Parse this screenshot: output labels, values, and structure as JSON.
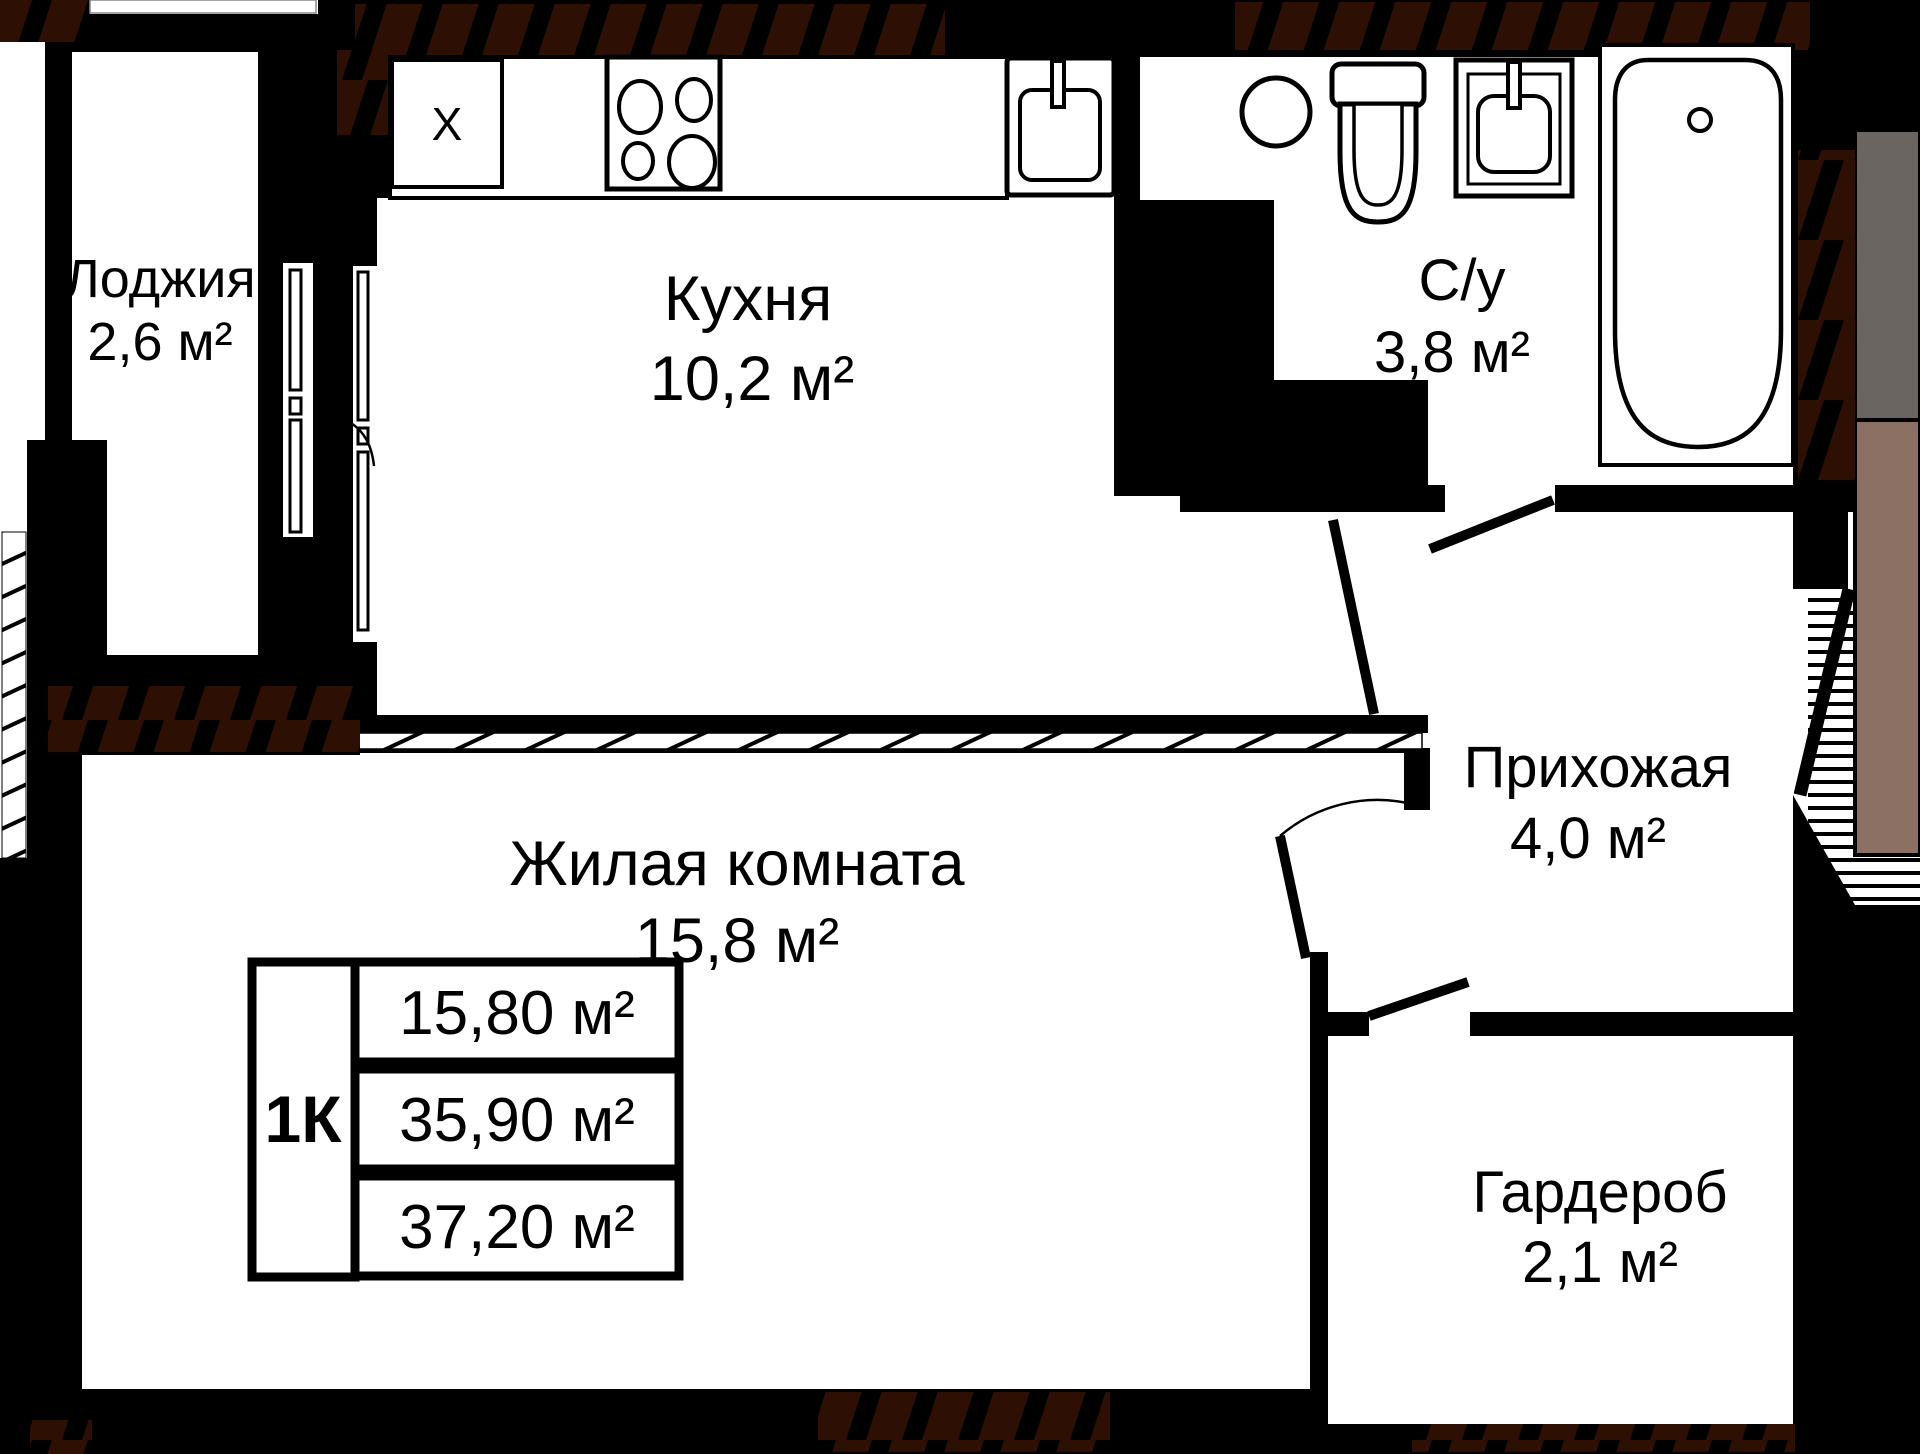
{
  "rooms": {
    "loggia": {
      "name": "Лоджия",
      "area": "2,6 м²"
    },
    "kitchen": {
      "name": "Кухня",
      "area": "10,2 м²"
    },
    "bathroom": {
      "name": "С/у",
      "area": "3,8 м²"
    },
    "hallway": {
      "name": "Прихожая",
      "area": "4,0 м²"
    },
    "living": {
      "name": "Жилая комната",
      "area": "15,8 м²"
    },
    "wardrobe": {
      "name": "Гардероб",
      "area": "2,1 м²"
    }
  },
  "appliances": {
    "fridge_label": "Х"
  },
  "info_table": {
    "type_label": "1К",
    "living_area": "15,80 м²",
    "total_area": "35,90 м²",
    "full_area": "37,20 м²"
  },
  "colors": {
    "walls": "#000000",
    "hatch_brown": "#2e0f03",
    "neighbor_dark_gray": "#6a6561",
    "neighbor_beige": "#8b7063"
  }
}
